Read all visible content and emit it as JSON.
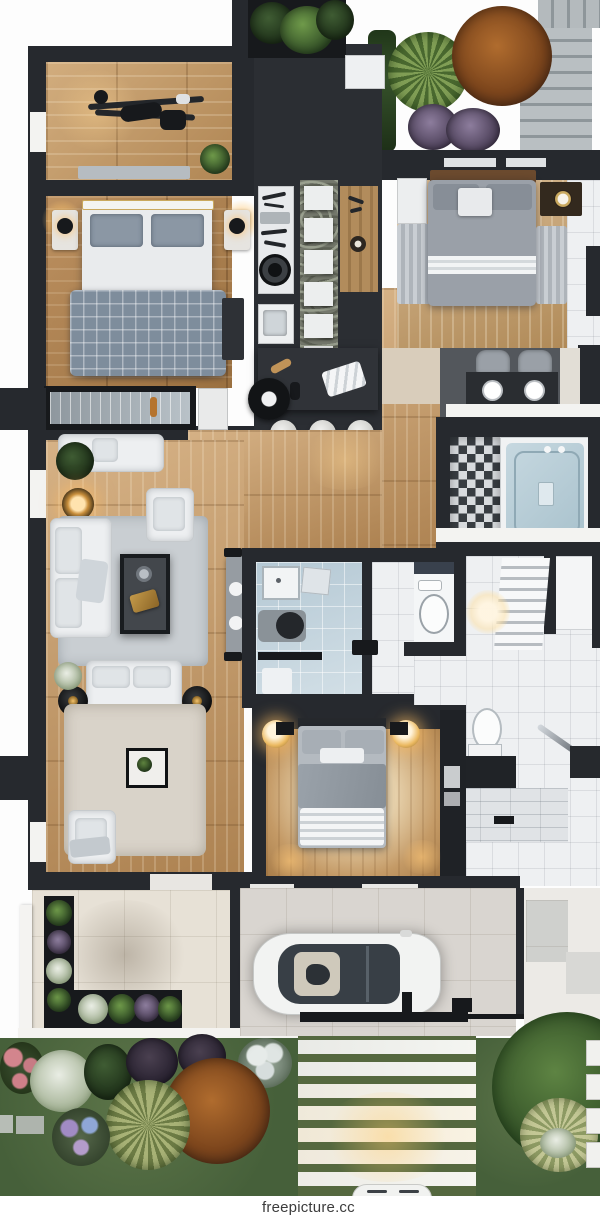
{
  "image": {
    "kind": "3d-floorplan-top-view-render"
  },
  "watermark": {
    "text": "freepicture.cc"
  },
  "palette": {
    "wall_dark": "#26292e",
    "wood_light": "#c9a478",
    "wood_warm": "#b98f5e",
    "tile_white": "#eef0f2",
    "tile_beige": "#e2dcd2",
    "blue_tile": "#b9cdd8",
    "lawn_green": "#4f6a40",
    "sofa_white": "#edeff1",
    "glow_amber": "#f0b75f",
    "tree_orange": "#9e5a26",
    "tree_green": "#3f6134"
  },
  "scene": {
    "rooms": [
      "gym-room",
      "bedroom-left",
      "kitchen",
      "bedroom-right",
      "bathtub-room",
      "living-room",
      "shower-bathroom",
      "wc",
      "staircase",
      "bedroom-lower",
      "garage-driveway",
      "patio",
      "garden"
    ],
    "vehicle": "white-car"
  }
}
